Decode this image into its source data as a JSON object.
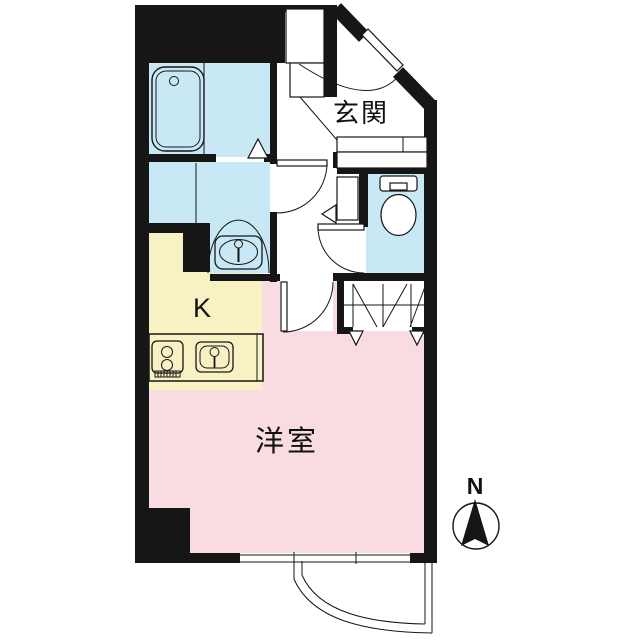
{
  "labels": {
    "entrance": "玄関",
    "kitchen": "K",
    "western_room": "洋室",
    "north": "N"
  },
  "colors": {
    "wet": "#c9e8f5",
    "kitchen": "#f8f1c4",
    "room": "#f9dbe2",
    "wall": "#161616",
    "bg": "#ffffff"
  }
}
